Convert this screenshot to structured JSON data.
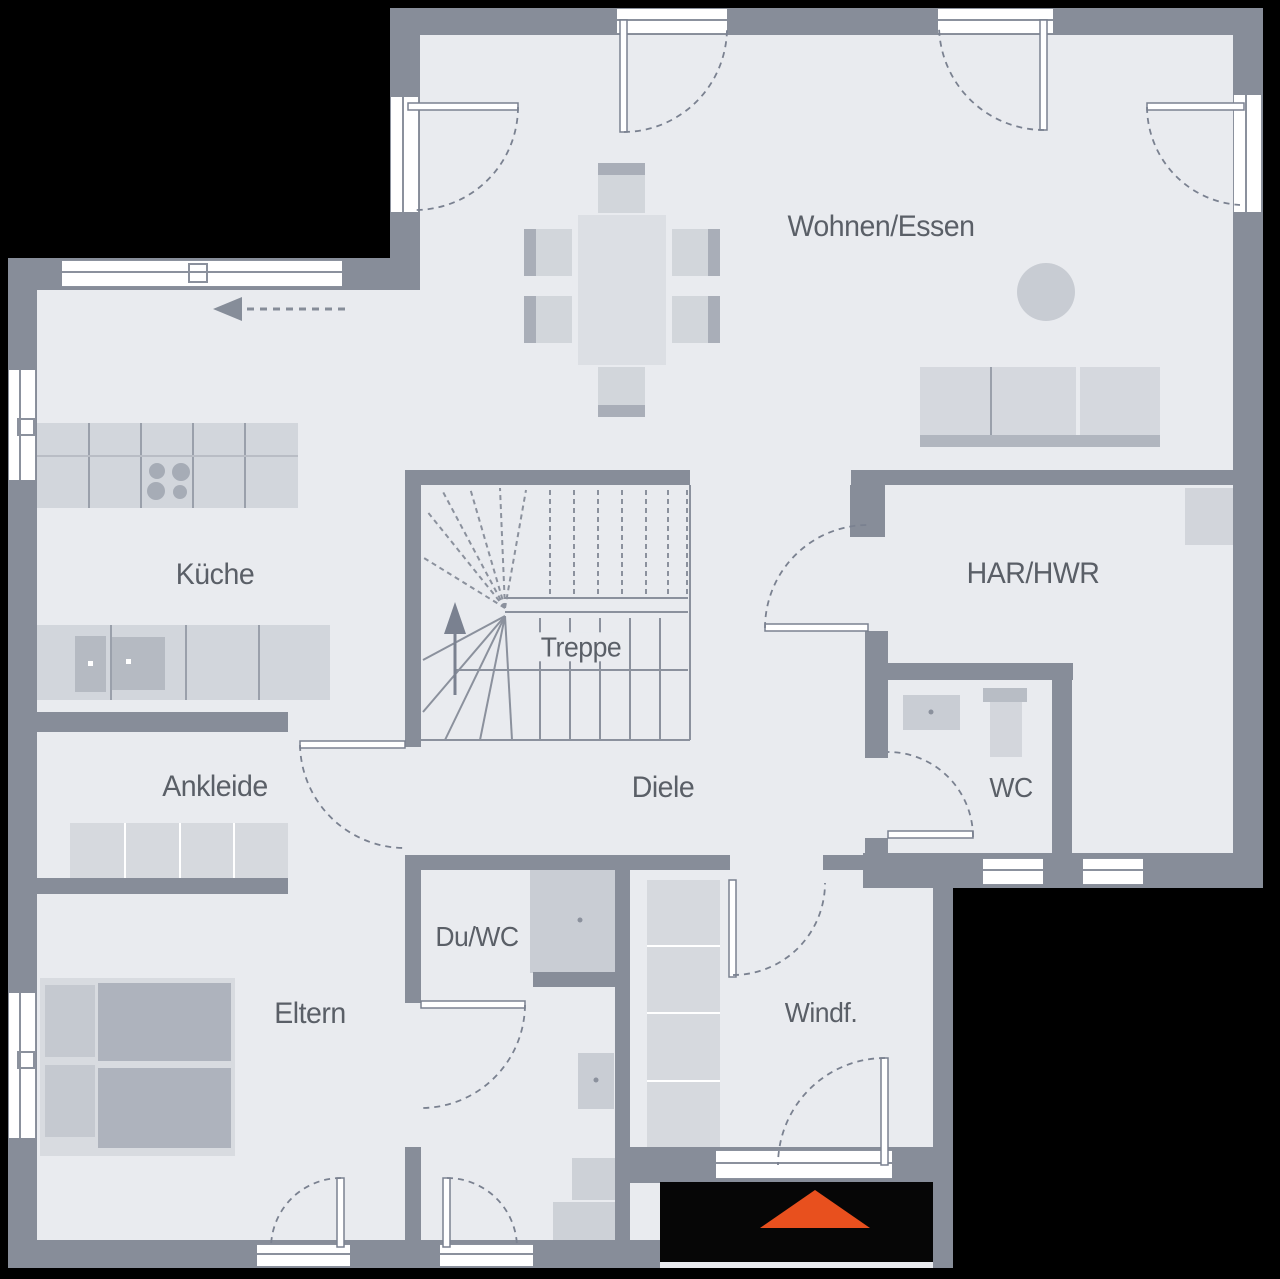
{
  "plan": {
    "rooms": {
      "wohnen_essen": {
        "label": "Wohnen/Essen"
      },
      "kueche": {
        "label": "Küche"
      },
      "treppe": {
        "label": "Treppe"
      },
      "har_hwr": {
        "label": "HAR/HWR"
      },
      "ankleide": {
        "label": "Ankleide"
      },
      "diele": {
        "label": "Diele"
      },
      "wc": {
        "label": "WC"
      },
      "du_wc": {
        "label": "Du/WC"
      },
      "eltern": {
        "label": "Eltern"
      },
      "windfang": {
        "label": "Windf."
      }
    },
    "colors": {
      "background": "#000000",
      "wall": "#878d99",
      "floor": "#e9ebef",
      "furniture": "#d6d9df",
      "window": "#ffffff",
      "text": "#5a5f67",
      "accent_orange": "#e8501e"
    },
    "entrance_marker": {
      "icon": "entrance-direction-triangle",
      "color": "#e8501e"
    }
  }
}
